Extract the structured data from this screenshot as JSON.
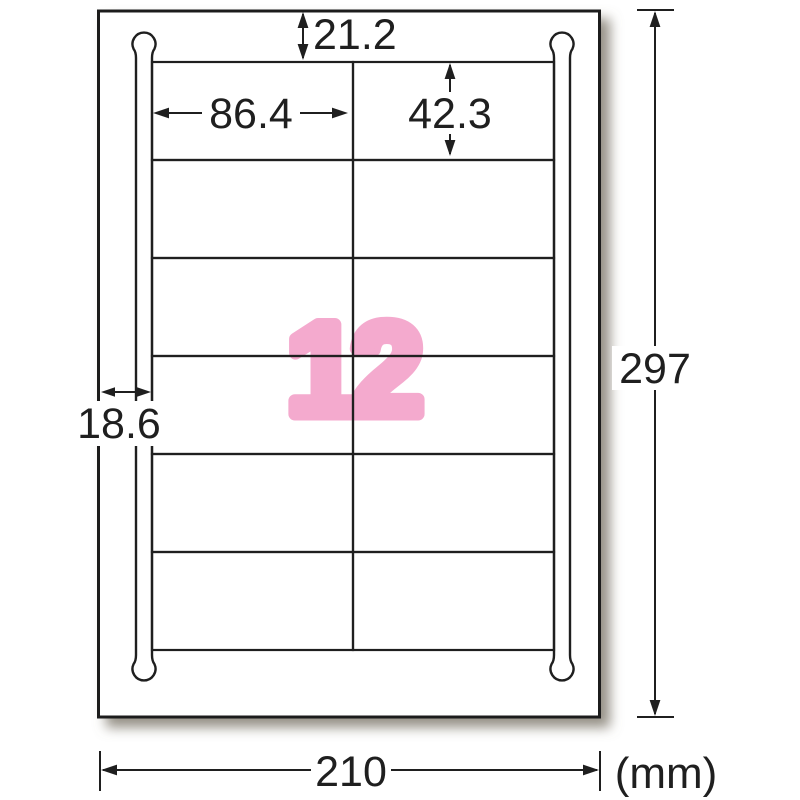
{
  "diagram": {
    "type": "label-sheet-dimension-diagram",
    "sheet": {
      "width_mm": "210",
      "height_mm": "297",
      "unit": "(mm)"
    },
    "labels": {
      "count": "12",
      "width_mm": "86.4",
      "height_mm": "42.3",
      "top_margin_mm": "21.2",
      "side_margin_mm": "18.6",
      "rows": 6,
      "columns": 2
    },
    "colors": {
      "count_pink": "#f4aace",
      "line": "#1f1f1f",
      "shadow": "#7a7567",
      "background": "#ffffff"
    }
  }
}
